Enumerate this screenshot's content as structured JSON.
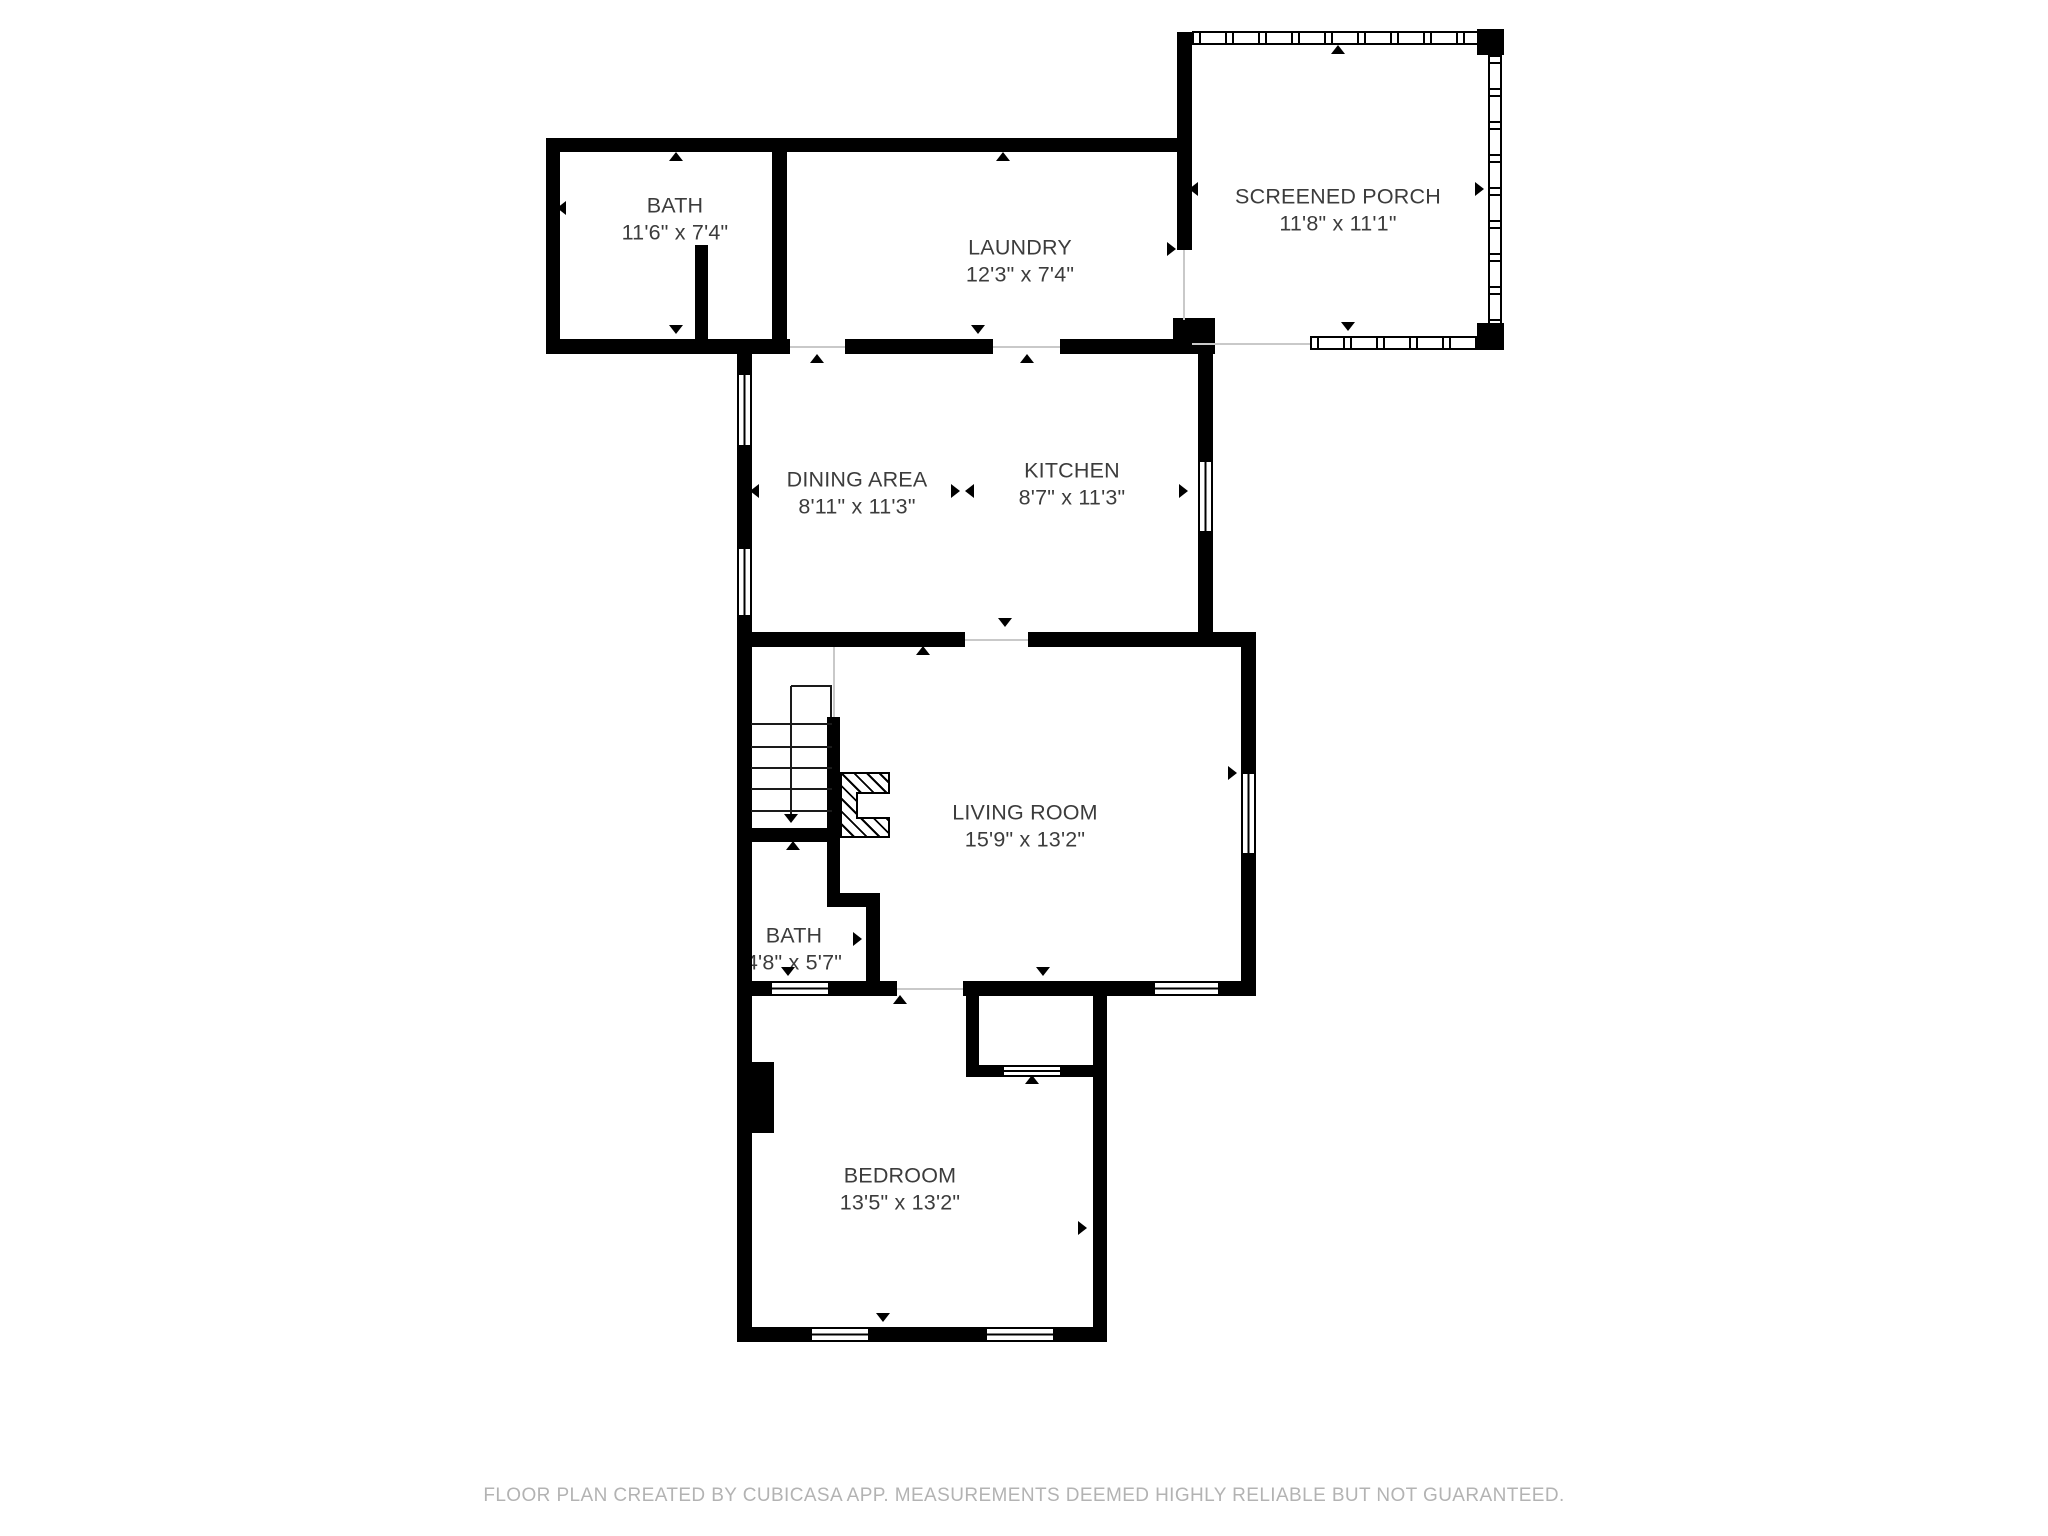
{
  "rooms": [
    {
      "id": "bath-upper",
      "name": "BATH",
      "dims": "11'6\" x 7'4\""
    },
    {
      "id": "laundry",
      "name": "LAUNDRY",
      "dims": "12'3\" x 7'4\""
    },
    {
      "id": "screened-porch",
      "name": "SCREENED PORCH",
      "dims": "11'8\" x 11'1\""
    },
    {
      "id": "dining-area",
      "name": "DINING AREA",
      "dims": "8'11\" x 11'3\""
    },
    {
      "id": "kitchen",
      "name": "KITCHEN",
      "dims": "8'7\" x 11'3\""
    },
    {
      "id": "living-room",
      "name": "LIVING ROOM",
      "dims": "15'9\" x 13'2\""
    },
    {
      "id": "bath-lower",
      "name": "BATH",
      "dims": "4'8\" x 5'7\""
    },
    {
      "id": "bedroom",
      "name": "BEDROOM",
      "dims": "13'5\" x 13'2\""
    }
  ],
  "footer": {
    "text": "FLOOR PLAN CREATED BY CUBICASA APP. MEASUREMENTS DEEMED HIGHLY RELIABLE BUT NOT GUARANTEED."
  },
  "colors": {
    "wall": "#000000",
    "background": "#ffffff",
    "label_text": "#3c3c3c",
    "footer_text": "#b3b3b3"
  }
}
